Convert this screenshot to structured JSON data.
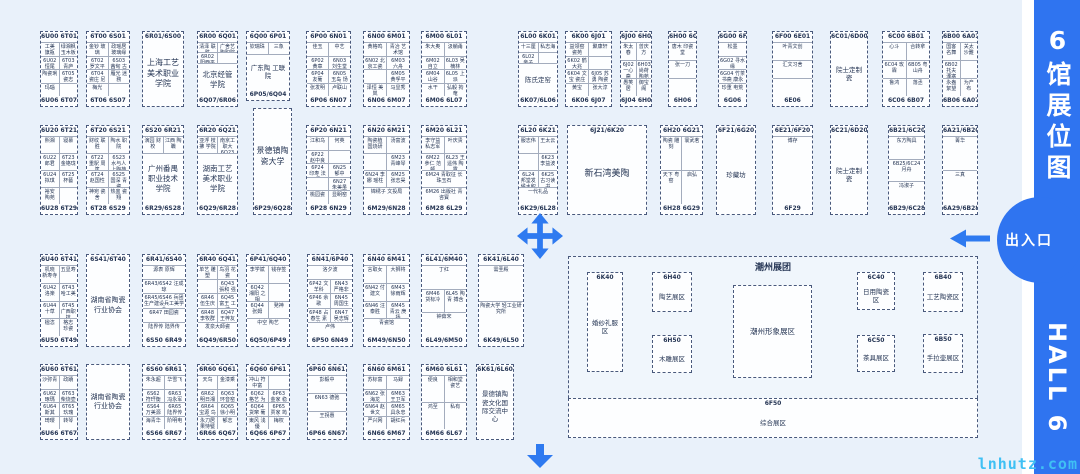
{
  "sidebar": {
    "title": "6馆展位图",
    "hall_name": "HALL 6",
    "exit_label": "出入口"
  },
  "watermark": {
    "text": "lnhutz.com"
  },
  "colors": {
    "accent_blue": "#2f74f0",
    "arrow_blue": "#2e7af0",
    "watermark_cyan": "#3fc0f4",
    "map_background": "#e9f1fa",
    "booth_line": "#49597c"
  },
  "icons": [
    "move-cross-arrow-icon",
    "down-arrow-icon",
    "left-arrow-icon"
  ],
  "blocks": [
    {
      "type": "section",
      "x": 568,
      "y": 256,
      "w": 410,
      "h": 182,
      "label": "潮州展团",
      "lx": 186,
      "ly": 6,
      "fs": 9
    },
    {
      "x": 40,
      "y": 31,
      "w": 38,
      "h": 76,
      "top": "6U00|6T01",
      "rows": [
        [
          "工美 旗瓶",
          "绿湘枫 玉木板"
        ],
        [
          "6U02 恒尾",
          "6T03 青庐"
        ],
        [
          "陶瓷琍",
          "6T05 瓷志"
        ],
        [
          "玛瑙",
          ""
        ]
      ],
      "bottom": "6U06|6T07"
    },
    {
      "x": 86,
      "y": 31,
      "w": 44,
      "h": 76,
      "top": "6T00|6S01",
      "rows": [
        [
          "金钞 玻璃",
          "政瑶居 玻璃缘"
        ],
        [
          "6T02 罗文平",
          "6S03 茜甸 古家"
        ],
        [
          "6T04 瓷庄 尼土",
          "雁光 迷務"
        ],
        [
          "梅光",
          ""
        ]
      ],
      "bottom": "6T06|6S07"
    },
    {
      "x": 142,
      "y": 31,
      "w": 42,
      "h": 76,
      "top": "6R01/6S00",
      "label": "上海工艺美术职业学院",
      "fs": 8
    },
    {
      "x": 197,
      "y": 31,
      "w": 41,
      "h": 76,
      "top": "6R00|6Q01",
      "rows": [
        [
          "清泽 联胜",
          "广舍艺 陶职院"
        ],
        [
          "6R02 阳西平",
          ""
        ]
      ],
      "label": "北京经管学院",
      "fs": 7.5,
      "bottom": "6Q07/6R06"
    },
    {
      "x": 246,
      "y": 31,
      "w": 44,
      "h": 70,
      "top": "6Q00|6P01",
      "rows": [
        [
          "钦瑞珠",
          "三象"
        ]
      ],
      "label": "广东陶 工联院",
      "bottom": "6P05/6Q04"
    },
    {
      "x": 306,
      "y": 31,
      "w": 45,
      "h": 76,
      "top": "6P00|6N01",
      "rows": [
        [
          "佳玉",
          "中艺"
        ],
        [
          "6P02 黄章",
          "6N03 刘生堂"
        ],
        [
          "6P04 友葡",
          "6N05 玉岛 饧馆"
        ],
        [
          "张发明",
          "卢联山"
        ]
      ],
      "bottom": "6P06|6N07"
    },
    {
      "x": 363,
      "y": 31,
      "w": 47,
      "h": 76,
      "top": "6N00|6M01",
      "rows": [
        [
          "黄格鸣",
          "青冶 艺术馆"
        ],
        [
          "6N02 北京工瓷",
          "6M03 六舟"
        ],
        [
          "",
          "6M05 黄孚平"
        ],
        [
          "泽恒 美岚",
          "马显秀"
        ]
      ],
      "bottom": "6N06|6M07"
    },
    {
      "x": 421,
      "y": 31,
      "w": 46,
      "h": 76,
      "top": "6M00|6L01",
      "rows": [
        [
          "朱大奥",
          "汲躺甬"
        ],
        [
          "6M02 自立",
          "6L03 吴楠林"
        ],
        [
          "6M04 山谷",
          "6L05 上派"
        ],
        [
          "水干",
          "弘毅 拘奄"
        ]
      ],
      "bottom": "6M06|6L07"
    },
    {
      "x": 518,
      "y": 31,
      "w": 40,
      "h": 76,
      "top": "6L00|6K01",
      "rows": [
        [
          "十三厘",
          "私志海"
        ],
        [
          "6L02 亲子",
          ""
        ]
      ],
      "label": "陈氏定窑",
      "bottom": "6K07/6L06"
    },
    {
      "x": 565,
      "y": 31,
      "w": 47,
      "h": 76,
      "top": "6K00|6J01",
      "rows": [
        [
          "益领窑 瓷苑",
          "聚康轩"
        ],
        [
          "6K02 鹤大兆",
          ""
        ],
        [
          "6K04 文宝 瓷庄",
          "6J05 苏勇 陶瓷"
        ],
        [
          "黄宝",
          "张大淳"
        ]
      ],
      "bottom": "6K06|6J07"
    },
    {
      "x": 620,
      "y": 31,
      "w": 32,
      "h": 76,
      "top": "6J00|6H01",
      "rows": [
        [
          "朱太春",
          "曾庆方"
        ],
        [
          "6J02 一心斋",
          "6H03 尚荷 陶苑"
        ],
        [
          "愚笑居",
          "御宝阁"
        ]
      ],
      "bottom": "6J04|6H05"
    },
    {
      "x": 668,
      "y": 31,
      "w": 29,
      "h": 76,
      "top": "6H00|6G01",
      "rows": [
        [
          "唐木 印瓷堂"
        ],
        [
          "张一刀"
        ],
        [
          ""
        ]
      ],
      "bottom": "6H06"
    },
    {
      "x": 718,
      "y": 31,
      "w": 29,
      "h": 76,
      "top": "6G00|6F01",
      "rows": [
        [
          "松墨"
        ],
        [
          "6G02 寻水缘"
        ],
        [
          "6G04 竹茶书斋 康永生"
        ],
        [
          "珍重 电荒"
        ]
      ],
      "bottom": "6G06"
    },
    {
      "x": 772,
      "y": 31,
      "w": 41,
      "h": 76,
      "top": "6F00|6E01",
      "rows": [
        [
          "叶青文创"
        ],
        [
          "汇文习舍"
        ],
        [
          ""
        ]
      ],
      "bottom": "6E06"
    },
    {
      "x": 830,
      "y": 31,
      "w": 38,
      "h": 76,
      "top": "6C01/6D00",
      "label": "院士定制瓷"
    },
    {
      "x": 882,
      "y": 31,
      "w": 48,
      "h": 76,
      "top": "6C00|6B01",
      "rows": [
        [
          "心斗",
          "合转拿"
        ],
        [
          "6C04 玫霖",
          "6B05 粤山舟"
        ],
        [
          "鲁鸿",
          "落丞"
        ]
      ],
      "bottom": "6C06|6B07"
    },
    {
      "x": 942,
      "y": 31,
      "w": 36,
      "h": 76,
      "top": "6B00|6A01",
      "rows": [
        [
          "国客 名舞",
          "关太 沙難"
        ],
        [
          "6B02 托夫 溧塞",
          ""
        ],
        [
          "永盎 絮望",
          "为产 布"
        ]
      ],
      "bottom": "6B06|6A07"
    },
    {
      "x": 40,
      "y": 125,
      "w": 38,
      "h": 90,
      "top": "6U20|6T21",
      "rows": [
        [
          "熙湘",
          "寝慕"
        ],
        [
          "6U22 郎君",
          "6T23 金铬珑"
        ],
        [
          "6U24 拟琪",
          "6T25 杯藝"
        ],
        [
          "裕安 陶苑",
          ""
        ]
      ],
      "bottom": "6U28|6T29"
    },
    {
      "x": 86,
      "y": 125,
      "w": 44,
      "h": 90,
      "top": "6T20|6S21",
      "rows": [
        [
          "财纹 联胜",
          "陶水 职院"
        ],
        [
          "6T22 重駅 周篤",
          "6S23 水与人 上陶苑"
        ],
        [
          "6T24 赵国性",
          "6S25 国深 青瓷"
        ],
        [
          "神宛 瓷舍",
          "热盅 瓷翔"
        ]
      ],
      "bottom": "6T28|6S29"
    },
    {
      "x": 142,
      "y": 125,
      "w": 42,
      "h": 90,
      "top": "6S20|6R21",
      "rows": [
        [
          "演园 财校",
          "江西 陶職"
        ]
      ],
      "label": "广州番禺职业技术学院",
      "fs": 7.5,
      "bottom": "6R29/6S28"
    },
    {
      "x": 197,
      "y": 125,
      "w": 41,
      "h": 90,
      "top": "6R20|6Q21",
      "rows": [
        [
          "亚浮 枝拂 学院",
          "南京工 职大 6Q23 李枝顺"
        ]
      ],
      "label": "湖南工艺美术职业学院",
      "fs": 7.5,
      "bottom": "6Q29/6R28"
    },
    {
      "x": 253,
      "y": 108,
      "w": 39,
      "h": 107,
      "label": "景德镇陶瓷大学",
      "fs": 8,
      "bottom": "6P29/6Q28"
    },
    {
      "x": 306,
      "y": 125,
      "w": 45,
      "h": 90,
      "top": "6P20|6N21",
      "rows": [
        [
          "江和乌",
          "何英"
        ],
        [
          "6P22 赵中良",
          ""
        ],
        [
          "6P24 印寿 法拜",
          "6N25 郁中"
        ],
        [
          "",
          "6N27 朱美虽"
        ],
        [
          "桃园瓷",
          "显眀窑"
        ]
      ],
      "bottom": "6P28|6N29"
    },
    {
      "x": 363,
      "y": 125,
      "w": 47,
      "h": 90,
      "top": "6N20|6M21",
      "rows": [
        [
          "陶瓷植 国烧研",
          "汤富波"
        ],
        [
          "",
          "6M23 青峰琴"
        ],
        [
          "6N24 李娜 瑶柱",
          "6M25 张志昊"
        ],
        [
          "锦绣子 文投局"
        ]
      ],
      "bottom": "6M29/6N28"
    },
    {
      "x": 421,
      "y": 125,
      "w": 46,
      "h": 90,
      "top": "6M20|6L21",
      "rows": [
        [
          "李守益 私志军",
          "叶庆贵"
        ],
        [
          "6M22 參仁 范顿",
          "6L23 王遥伟 陶露"
        ],
        [
          "6M24 青取征 长珠玉石"
        ],
        [
          "6M26 出版社 青咨寳"
        ]
      ],
      "bottom": "6M28|6L29"
    },
    {
      "x": 518,
      "y": 125,
      "w": 40,
      "h": 90,
      "top": "6L20|6K21",
      "rows": [
        [
          "服志伟",
          "王太云"
        ],
        [
          "",
          "6K23 李益波"
        ],
        [
          "6L24 邦堂发 候水积",
          "6K25 古习读书"
        ],
        [
          "一代礼品"
        ]
      ],
      "bottom": "6K29/6L28"
    },
    {
      "x": 567,
      "y": 125,
      "w": 80,
      "h": 90,
      "top": "6J21/6K20",
      "label": "新石湾美陶",
      "fs": 9
    },
    {
      "x": 660,
      "y": 125,
      "w": 43,
      "h": 90,
      "top": "6H20|6G21",
      "rows": [
        [
          "陶瓷 雕刻",
          "寰武茗"
        ],
        [
          "天下 粤窑",
          "启弘"
        ]
      ],
      "bottom": "6H28|6G29"
    },
    {
      "x": 716,
      "y": 125,
      "w": 40,
      "h": 90,
      "top": "6F21/6G20",
      "label": "珍藏坊"
    },
    {
      "x": 772,
      "y": 125,
      "w": 41,
      "h": 90,
      "top": "6E21/6F20",
      "rows": [
        [
          "博存"
        ]
      ],
      "bottom": "6F29"
    },
    {
      "x": 830,
      "y": 125,
      "w": 38,
      "h": 90,
      "top": "6C21/6D20",
      "label": "院士定制瓷"
    },
    {
      "x": 888,
      "y": 125,
      "w": 37,
      "h": 90,
      "top": "6B21/6C20",
      "rows": [
        [
          "东方陶具"
        ],
        [
          "6B25/6C24 月舟"
        ],
        [
          "冯淑子"
        ]
      ],
      "bottom": "6B29/6C28"
    },
    {
      "x": 942,
      "y": 125,
      "w": 36,
      "h": 90,
      "top": "6A21/6B20",
      "rows": [
        [
          "菁华"
        ],
        [
          "三真"
        ]
      ],
      "bottom": "6A29/6B28"
    },
    {
      "x": 40,
      "y": 254,
      "w": 38,
      "h": 93,
      "top": "6U40|6T41",
      "rows": [
        [
          "机晓 新寿寺",
          "五显寿"
        ],
        [
          "6U42 洛楽",
          "6T43 哈工美"
        ],
        [
          "6U44 十草",
          "6T45 广西职技"
        ],
        [
          "楹恣",
          "格志 珍瓷"
        ]
      ],
      "bottom": "6U50|6T49"
    },
    {
      "x": 86,
      "y": 254,
      "w": 44,
      "h": 93,
      "top": "6S41/6T40",
      "label": "湖南省陶瓷行业协会",
      "fs": 7
    },
    {
      "x": 142,
      "y": 254,
      "w": 44,
      "h": 93,
      "top": "6R41/6S40",
      "rows": [
        [
          "源表 原辉"
        ],
        [
          "6R43/6S42 汪成琼"
        ],
        [
          "6R45/6S46 兵团生产建设兵工美学会"
        ],
        [
          "6R47 田园瓷"
        ],
        [
          "陆界传 陆界传"
        ]
      ],
      "bottom": "6S50|6R49"
    },
    {
      "x": 197,
      "y": 254,
      "w": 41,
      "h": 93,
      "top": "6R40|6Q41",
      "rows": [
        [
          "单艺 雕塑",
          "鸟羽 花瓷"
        ],
        [
          "",
          "6Q43 張和 强艺"
        ],
        [
          "6R46 伍生庆",
          "6Q45 富王 工坊"
        ],
        [
          "6R48 李牧群",
          "6Q47 王梓友"
        ],
        [
          "发泉大師瓷"
        ]
      ],
      "bottom": "6Q49/6R50"
    },
    {
      "x": 246,
      "y": 254,
      "w": 44,
      "h": 93,
      "top": "6P41/6Q40",
      "rows": [
        [
          "李学斌",
          "钱存签"
        ],
        [
          "6Q42 湘阳 之相",
          ""
        ],
        [
          "6Q44 张姆",
          "発神"
        ],
        [
          "中空 陶艺"
        ]
      ],
      "bottom": "6Q50/6P49"
    },
    {
      "x": 307,
      "y": 254,
      "w": 46,
      "h": 93,
      "top": "6N41/6P40",
      "rows": [
        [
          "洛夕波"
        ],
        [
          "6P42 文羊科",
          "6N43 严格非"
        ],
        [
          "6P46 余歌",
          "6N45 周国生"
        ],
        [
          "6P48 占春生 素筠",
          "6N47 吴志辉 刘志英"
        ],
        [
          "卢伟"
        ]
      ],
      "bottom": "6P50|6N49"
    },
    {
      "x": 363,
      "y": 254,
      "w": 47,
      "h": 93,
      "top": "6N40|6M41",
      "rows": [
        [
          "言取女",
          "大狮将"
        ],
        [
          "6N42 付建文",
          "6M43 徐雨辉"
        ],
        [
          "6N46 汪泰胜",
          "6M45 青云 庚扬"
        ],
        [
          "青瓷馆"
        ]
      ],
      "bottom": "6M49/6N50"
    },
    {
      "x": 421,
      "y": 254,
      "w": 46,
      "h": 93,
      "top": "6L41/6M40",
      "rows": [
        [
          "丁红"
        ],
        [
          "6M46 货标冷",
          "6L45 陶青 搏含"
        ],
        [
          "钟茹宋"
        ]
      ],
      "bottom": "6L49/6M50"
    },
    {
      "x": 478,
      "y": 254,
      "w": 46,
      "h": 93,
      "top": "6K41/6L40",
      "rows": [
        [
          "需圣殿"
        ],
        [
          "陶瓷大学 轻工业研究所"
        ]
      ],
      "bottom": "6K49/6L50"
    },
    {
      "x": 40,
      "y": 364,
      "w": 38,
      "h": 76,
      "top": "6U60|6T61",
      "rows": [
        [
          "沙弥青",
          "政蹟"
        ],
        [
          "6U62 琢瑪",
          "6T63 柴烧壶"
        ],
        [
          "6U64 斯其",
          "6T65 玖瑰"
        ],
        [
          "琦璎",
          "转琴"
        ]
      ],
      "bottom": "6U66|6T67"
    },
    {
      "x": 86,
      "y": 364,
      "w": 44,
      "h": 76,
      "label": "湖南省陶瓷行业协会",
      "fs": 7
    },
    {
      "x": 142,
      "y": 364,
      "w": 44,
      "h": 76,
      "top": "6S60|6R61",
      "rows": [
        [
          "朱永超",
          "华雪飞"
        ],
        [
          "6S62 符玕衡",
          "6R63 冯永军"
        ],
        [
          "6S64 万美源",
          "6R65 陆界传"
        ],
        [
          "海青华",
          "阶明电"
        ]
      ],
      "bottom": "6S66|6R67"
    },
    {
      "x": 197,
      "y": 364,
      "w": 41,
      "h": 76,
      "top": "6R60|6Q61",
      "rows": [
        [
          "天鸟",
          "金漆乘"
        ],
        [
          "6R62 明日湘窑",
          "6Q63 环音窑"
        ],
        [
          "6R64 宝源 鸟超",
          "6Q65 徐小明"
        ],
        [
          "永刀居 果恃甓",
          "郁志"
        ]
      ],
      "bottom": "6R66|6Q67"
    },
    {
      "x": 246,
      "y": 364,
      "w": 44,
      "h": 76,
      "top": "6Q60|6P61",
      "rows": [
        [
          "冲山 符中富",
          ""
        ],
        [
          "6Q62 格艺 为应",
          "6P63 金家 稳藏"
        ],
        [
          "6Q64 货窜 葡家",
          "6P65 贾家 筠窑"
        ],
        [
          "東风 浅優",
          "梅权"
        ]
      ],
      "bottom": "6Q66|6P67"
    },
    {
      "x": 307,
      "y": 364,
      "w": 40,
      "h": 76,
      "top": "6P60|6N61",
      "rows": [
        [
          "彭毅中"
        ],
        [
          "6N63 德弛"
        ],
        [
          "王拐惠"
        ]
      ],
      "bottom": "6P66|6N67"
    },
    {
      "x": 363,
      "y": 364,
      "w": 47,
      "h": 76,
      "top": "6N60|6M61",
      "rows": [
        [
          "苏标富",
          "马録"
        ],
        [
          "6N62 张海龙",
          "6M63 王卫军"
        ],
        [
          "6N64 赵世文",
          "6M65 具永忠"
        ],
        [
          "严兴网",
          "胡红兵"
        ]
      ],
      "bottom": "6N66|6M67"
    },
    {
      "x": 421,
      "y": 364,
      "w": 46,
      "h": 76,
      "top": "6M60|6L61",
      "rows": [
        [
          "便良",
          "相和堂 瓷艺"
        ],
        [
          "鸿至",
          "私有"
        ]
      ],
      "bottom": "6M66|6L67"
    },
    {
      "x": 476,
      "y": 364,
      "w": 38,
      "h": 76,
      "top": "6K61/6L60",
      "label": "景德镇陶瓷文化国际交流中心",
      "fs": 6.5
    },
    {
      "x": 587,
      "y": 272,
      "w": 36,
      "h": 100,
      "top": "6K40",
      "label": "婚纱礼服区"
    },
    {
      "x": 652,
      "y": 272,
      "w": 40,
      "h": 40,
      "top": "6H40",
      "label": "陶艺展区"
    },
    {
      "x": 652,
      "y": 335,
      "w": 40,
      "h": 38,
      "top": "6H50",
      "label": "木雕展区"
    },
    {
      "x": 733,
      "y": 285,
      "w": 79,
      "h": 93,
      "label": "潮州形象展区",
      "fs": 7.5
    },
    {
      "x": 857,
      "y": 272,
      "w": 38,
      "h": 38,
      "top": "6C40",
      "label": "日用陶瓷区"
    },
    {
      "x": 857,
      "y": 335,
      "w": 38,
      "h": 37,
      "top": "6C50",
      "label": "茶具展区"
    },
    {
      "x": 923,
      "y": 272,
      "w": 40,
      "h": 40,
      "top": "6B40",
      "label": "工艺陶瓷区"
    },
    {
      "x": 923,
      "y": 334,
      "w": 40,
      "h": 39,
      "top": "6B50",
      "label": "手拉壶展区"
    },
    {
      "x": 568,
      "y": 398,
      "w": 410,
      "h": 40,
      "top": "6F50",
      "label": "综合展区"
    }
  ]
}
